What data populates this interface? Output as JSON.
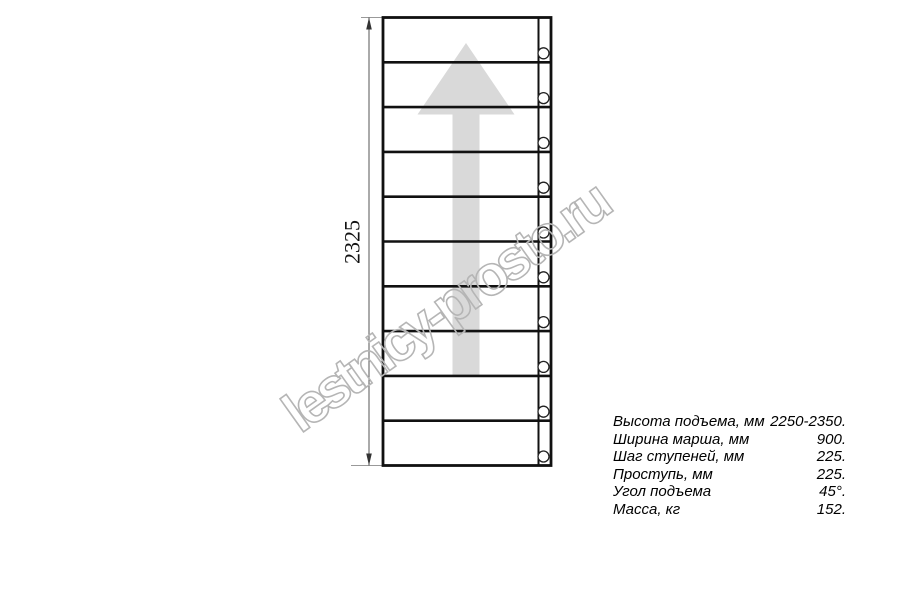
{
  "drawing": {
    "title": "ladder-flight-top-view",
    "dimension_label": "2325",
    "visible_steps": 10,
    "visible_bolts": 10,
    "watermark": "lestnicy-prosto.ru"
  },
  "specs": {
    "rows": [
      {
        "label": "Высота подъема, мм",
        "value": "2250-2350."
      },
      {
        "label": "Ширина марша, мм",
        "value": "900."
      },
      {
        "label": "Шаг ступеней, мм",
        "value": "225."
      },
      {
        "label": "Проступь, мм",
        "value": "225."
      },
      {
        "label": "Угол подъема",
        "value": "45°."
      },
      {
        "label": "Масса, кг",
        "value": "152."
      }
    ]
  },
  "colors": {
    "outline": "#111111",
    "thin_line": "#555555",
    "extension_line": "#999999",
    "arrow_fill": "#d9d9d9",
    "watermark_stroke": "#b5b5b5",
    "background": "#ffffff"
  }
}
